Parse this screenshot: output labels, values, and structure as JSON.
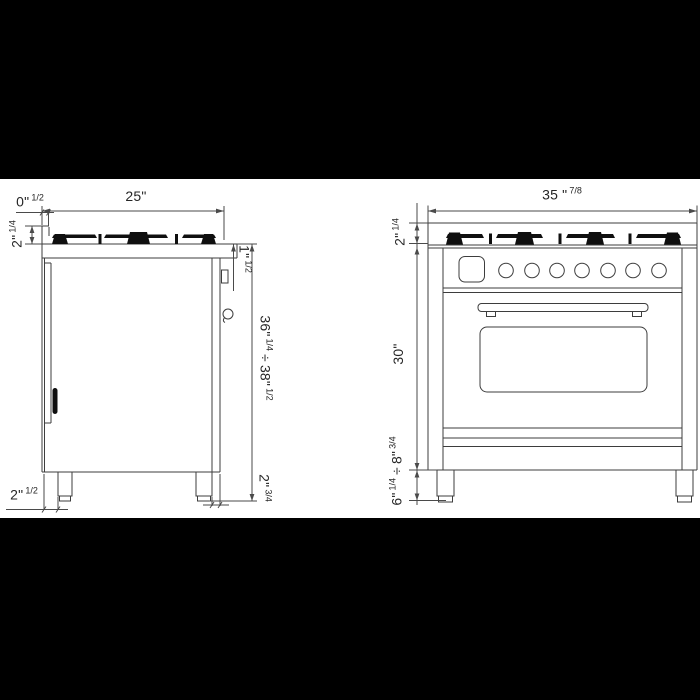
{
  "colors": {
    "letterbox": "#000000",
    "paper": "#ffffff",
    "line": "#3d3d3d",
    "dim_line": "#4a4a4a",
    "ink": "#262626",
    "grate_fill": "#0f0f0f"
  },
  "labels": {
    "side_view": {
      "rear_overhang": {
        "value": "0\"",
        "fraction": "1/2"
      },
      "depth": {
        "value": "25\""
      },
      "cooktop_height": {
        "value": "2\"",
        "fraction": "1/4"
      },
      "front_lip": {
        "value": "1\"",
        "fraction": "1/2"
      },
      "overall_height": {
        "min": "36\"",
        "min_fraction": "1/4",
        "divider": "÷",
        "max": "38\"",
        "max_fraction": "1/2"
      },
      "rear_leg_inset": {
        "value": "2\"",
        "fraction": "1/2"
      },
      "front_leg_inset": {
        "value": "2\"",
        "fraction": "3/4"
      }
    },
    "front_view": {
      "width": {
        "value": "35 \"",
        "fraction": "7/8"
      },
      "cooktop_height": {
        "value": "2\"",
        "fraction": "1/4"
      },
      "oven_height": {
        "value": "30\""
      },
      "leg_height": {
        "min": "6\"",
        "min_fraction": "1/4",
        "divider": "÷",
        "max": "8\"",
        "max_fraction": "3/4"
      }
    }
  }
}
